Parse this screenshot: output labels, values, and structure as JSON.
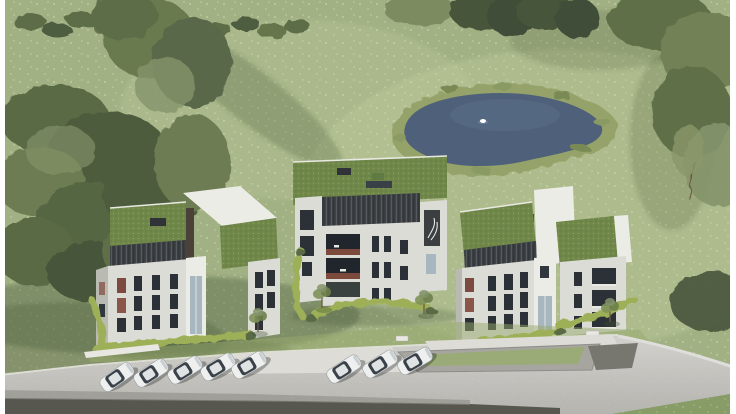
{
  "meta": {
    "kind": "architectural-aerial-render",
    "description": "Aerial 3D visualization of a new residential project: three modern white apartment buildings with green sedum roofs and dark slatted penthouse levels, landscaped gardens with hedges and saplings, a natural pond with one swan, surrounding meadow and tree groves, and a curved access road with an underground garage ramp and parked cars.",
    "width": 736,
    "height": 414
  },
  "palette": {
    "frame_white": "#ffffff",
    "meadow": "#a2b184",
    "meadow_light": "#c2cfa0",
    "flower_speckle": "#e3eac6",
    "grass_shadow": "#4c5c3c",
    "tree": "#5d6d47",
    "tree_dark": "#46543a",
    "tree_light": "#84936a",
    "hedge": "#9db058",
    "pond_reeds": "#95a269",
    "pond_water": "#4f617a",
    "pond_water_light": "#5d7089",
    "roof_green": "#70874a",
    "facade_white": "#dcdcd6",
    "facade_shade": "#b9bab2",
    "facade_bright": "#ecece6",
    "slat_dark": "#3b3f42",
    "wood_core": "#4a4238",
    "window_dark": "#2b3136",
    "glass_light": "#a7b6bf",
    "deck_red": "#7c4a3c",
    "accent_red": "#7c4a40",
    "accent_red2": "#8a564a",
    "road": "#cbcac6",
    "road_dark": "#57564f",
    "road_light": "#dddcd7",
    "car_body": "#eef0f0",
    "car_glass": "#3a4148",
    "swan": "#ffffff"
  },
  "scene": {
    "buildings": [
      {
        "id": "left",
        "roof": "green sedum, two levels",
        "penthouse": "dark slatted cladding",
        "facade": "white with dark vertical windows and red-toned window accents"
      },
      {
        "id": "center",
        "roof": "large green sedum roof with skylights",
        "facade": "white with recessed balconies and red-brown wood decks"
      },
      {
        "id": "right",
        "roof": "green sedum, two levels",
        "penthouse": "dark slatted cladding",
        "facade": "white with dark windows and red-toned window accents"
      }
    ],
    "pond": {
      "present": true,
      "swan_count": 1,
      "border": "reeds"
    },
    "parking": {
      "car_groups": [
        5,
        3
      ],
      "total_cars": 8,
      "car_color": "white/silver",
      "ramp": "underground garage entrance"
    },
    "benches": 2,
    "frame": "thin white bars on left and right image edges"
  }
}
